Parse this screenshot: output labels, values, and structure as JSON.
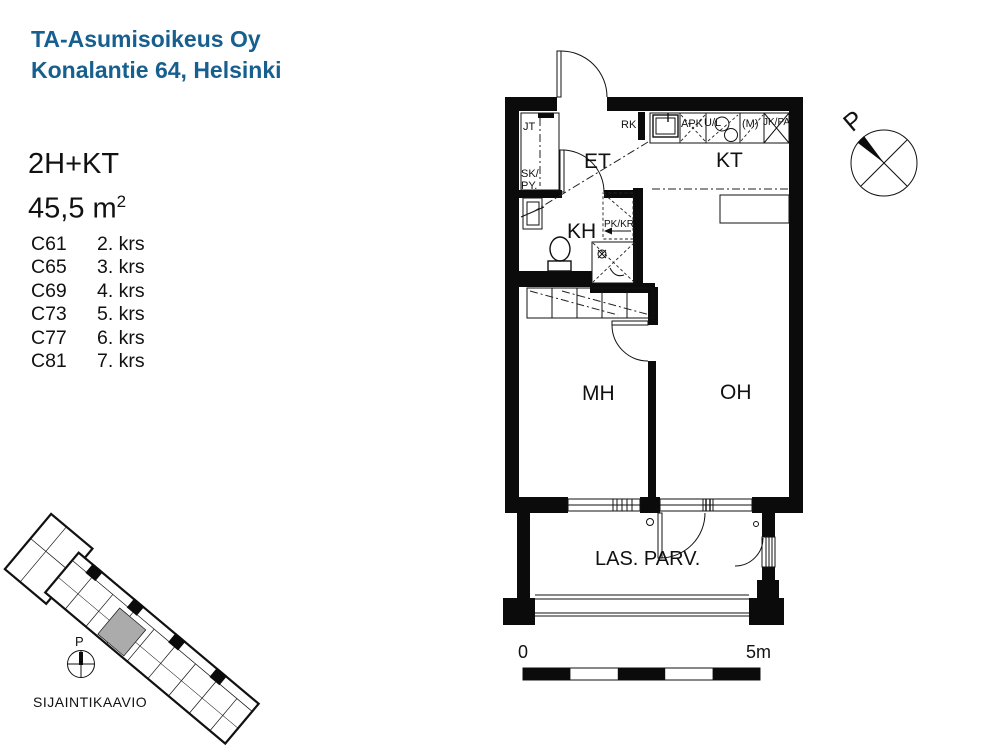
{
  "colors": {
    "brand_blue": "#175F8F",
    "ink": "#000000",
    "site_highlight": "#ABABAB"
  },
  "header": {
    "line1": "TA-Asumisoikeus Oy",
    "line2": "Konalantie 64, Helsinki"
  },
  "apartment": {
    "layout": "2H+KT",
    "area": "45,5 m",
    "area_sup": "2"
  },
  "units": [
    {
      "code": "C61",
      "floor": "2. krs"
    },
    {
      "code": "C65",
      "floor": "3. krs"
    },
    {
      "code": "C69",
      "floor": "4. krs"
    },
    {
      "code": "C73",
      "floor": "5. krs"
    },
    {
      "code": "C77",
      "floor": "6. krs"
    },
    {
      "code": "C81",
      "floor": "7. krs"
    }
  ],
  "plan": {
    "rooms": {
      "et": "ET",
      "kt": "KT",
      "kh": "KH",
      "mh": "MH",
      "oh": "OH",
      "balcony": "LAS. PARV."
    },
    "labels": {
      "jt": "JT",
      "sk": "SK/",
      "py": "PY.",
      "rk": "RK",
      "apk": "APK",
      "ul": "U/L",
      "m": "(M)",
      "jkpa": "JK/PA",
      "pkkr": "PK/KR"
    },
    "compass": "P",
    "scale": {
      "zero": "0",
      "five": "5m"
    }
  },
  "site": {
    "caption": "SIJAINTIKAAVIO",
    "compass": "P"
  }
}
